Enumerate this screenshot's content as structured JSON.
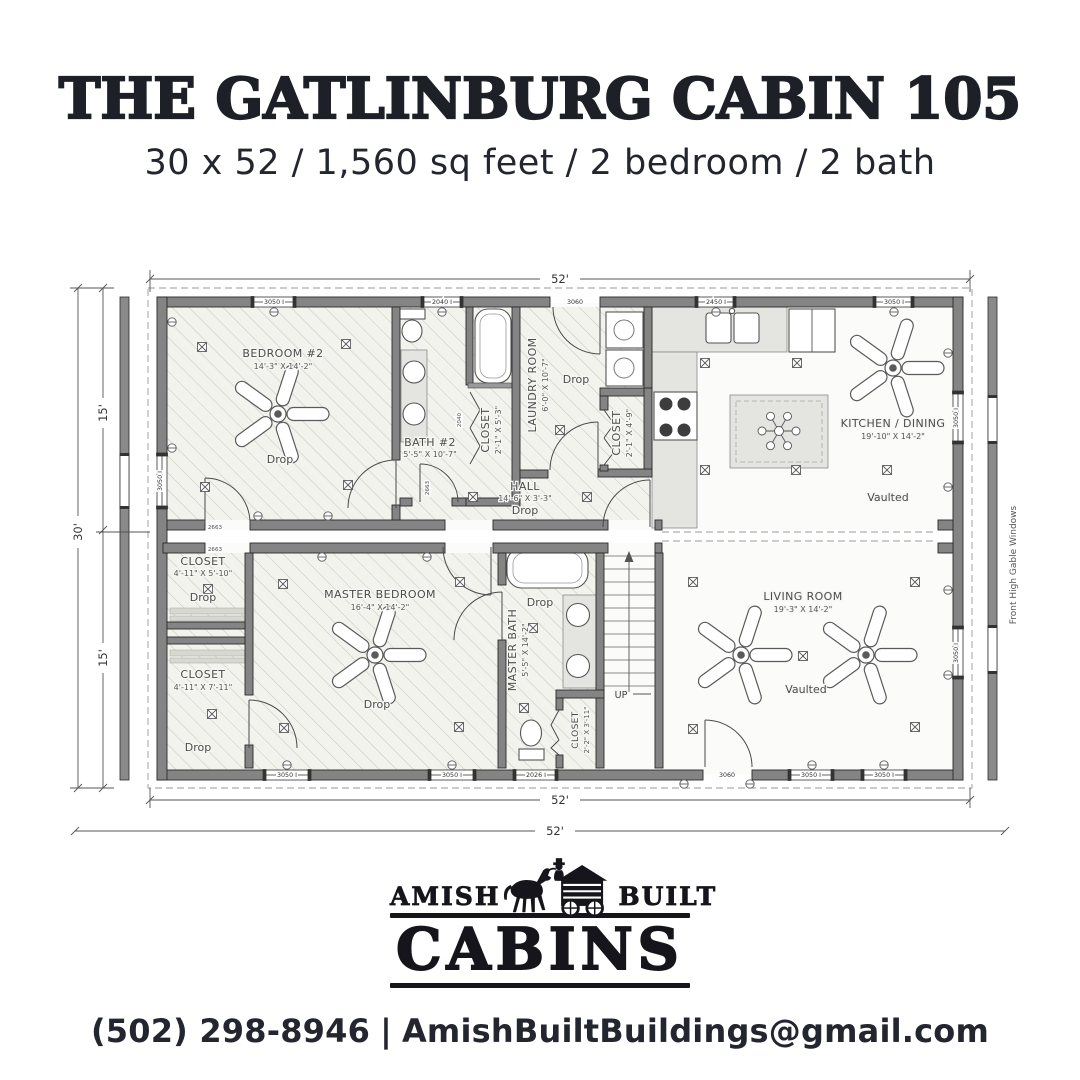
{
  "header": {
    "title": "THE GATLINBURG CABIN 105",
    "subtitle": "30 x 52 / 1,560 sq feet / 2 bedroom / 2 bath"
  },
  "plan": {
    "dims": {
      "top": "52'",
      "bottom_inner": "52'",
      "bottom_outer": "52'",
      "left_overall": "30'",
      "left_top": "15'",
      "left_bottom": "15'"
    },
    "note_right": "Front High Gable Windows",
    "drop": "Drop",
    "vaulted": "Vaulted",
    "stairs": {
      "up": "UP"
    },
    "rooms": {
      "bedroom2": {
        "name": "BEDROOM #2",
        "dims": "14'-3\" X 14'-2\""
      },
      "bath2": {
        "name": "BATH #2",
        "dims": "5'-5\" X 10'-7\""
      },
      "closet_bath2": {
        "name": "CLOSET",
        "dims": "2'-1\" X 5'-3\""
      },
      "laundry": {
        "name": "LAUNDRY ROOM",
        "dims": "6'-0\" X 10'-7\""
      },
      "closet_pantry": {
        "name": "CLOSET",
        "dims": "2'-1\" X 4'-9\""
      },
      "hall": {
        "name": "HALL",
        "dims": "14'-6\" X 3'-3\""
      },
      "kitchen": {
        "name": "KITCHEN / DINING",
        "dims": "19'-10\" X 14'-2\""
      },
      "closet1": {
        "name": "CLOSET",
        "dims": "4'-11\" X 5'-10\""
      },
      "closet2": {
        "name": "CLOSET",
        "dims": "4'-11\" X 7'-11\""
      },
      "master": {
        "name": "MASTER BEDROOM",
        "dims": "16'-4\" X 14'-2\""
      },
      "masterbath": {
        "name": "MASTER BATH",
        "dims": "5'-5\" X 14'-2\""
      },
      "closet_stair": {
        "name": "CLOSET",
        "dims": "2'-2\" X 3'-11\""
      },
      "living": {
        "name": "LIVING ROOM",
        "dims": "19'-3\" X 14'-2\""
      }
    },
    "windows": {
      "w3050": "3050 I",
      "w2040": "2040 I",
      "w2450": "2450 I",
      "w2026": "2026 I",
      "w3060": "3060"
    },
    "door_labels": {
      "d2663": "2663",
      "d2040": "2040"
    }
  },
  "logo": {
    "amish": "AMISH",
    "built": "BUILT",
    "cabins": "CABINS"
  },
  "contact": {
    "phone": "(502) 298-8946",
    "separator": "|",
    "email": "AmishBuiltBuildings@gmail.com"
  }
}
